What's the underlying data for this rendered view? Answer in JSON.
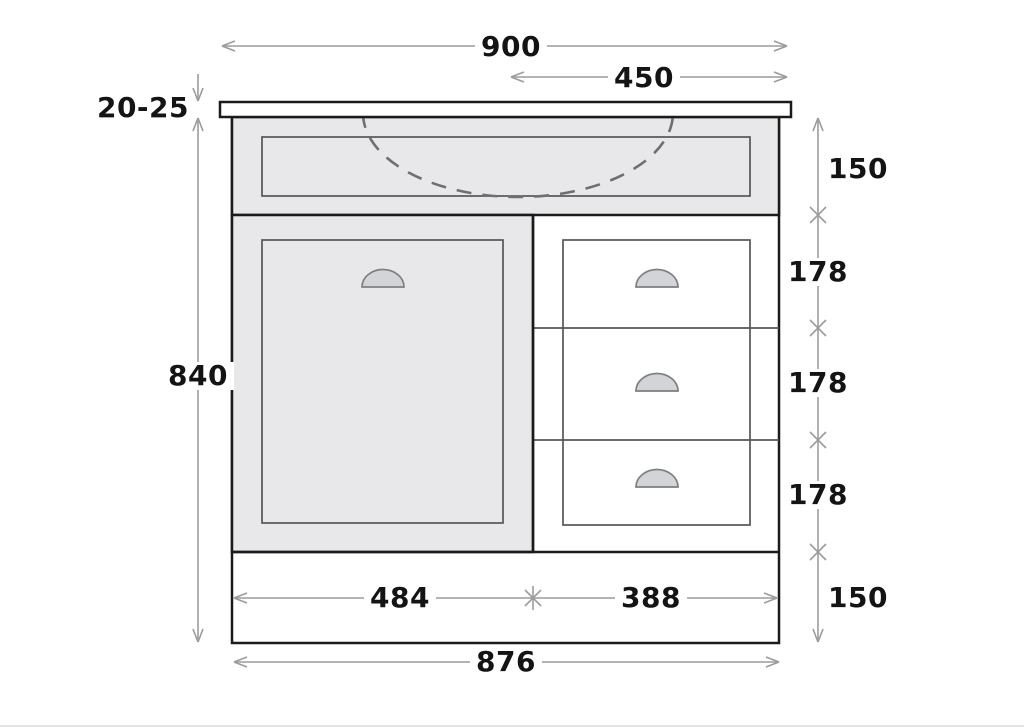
{
  "drawing": {
    "dimension_labels": {
      "overall_width": "900",
      "basin_center_offset": "450",
      "top_thickness": "20-25",
      "cabinet_height": "840",
      "apron_height": "150",
      "drawer_1_height": "178",
      "drawer_2_height": "178",
      "drawer_3_height": "178",
      "plinth_height": "150",
      "door_width": "484",
      "drawer_bank_width": "388",
      "carcass_width": "876"
    },
    "colors": {
      "panel_fill": "#e8e8ea",
      "outline": "#1b1b1b",
      "inner_line": "#54565a",
      "dimension_line": "#9a9c9e",
      "sink_dash": "#6d7073",
      "handle_fill": "#d3d4d7",
      "handle_stroke": "#7c7f83",
      "label_text": "#141414"
    }
  }
}
